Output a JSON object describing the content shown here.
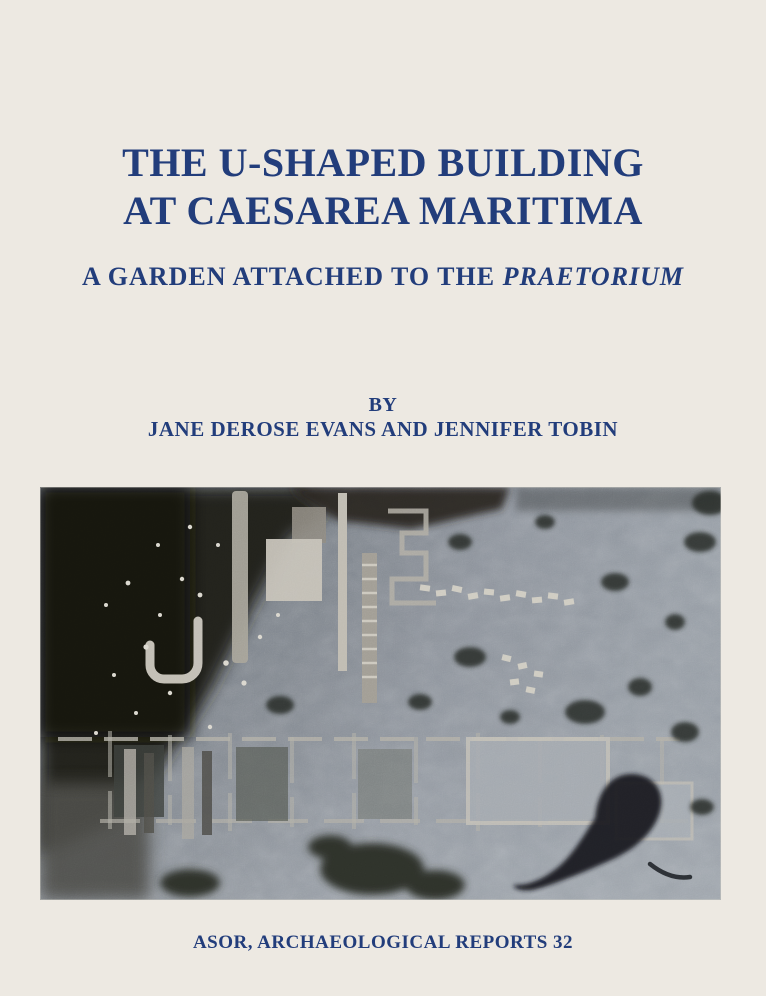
{
  "page": {
    "background_color": "#EDE9E2",
    "accent_color": "#223D7B"
  },
  "cover": {
    "title_line1": "THE U-SHAPED BUILDING",
    "title_line2": "AT CAESAREA MARITIMA",
    "subtitle": {
      "prefix": "A GARDEN ATTACHED TO THE ",
      "emphasis": "PRAETORIUM"
    },
    "byline": "BY",
    "authors": "JANE DEROSE EVANS AND JENNIFER TOBIN",
    "series": "ASOR, ARCHAEOLOGICAL REPORTS 32",
    "photo": {
      "name": "aerial-photo-of-excavation"
    }
  }
}
